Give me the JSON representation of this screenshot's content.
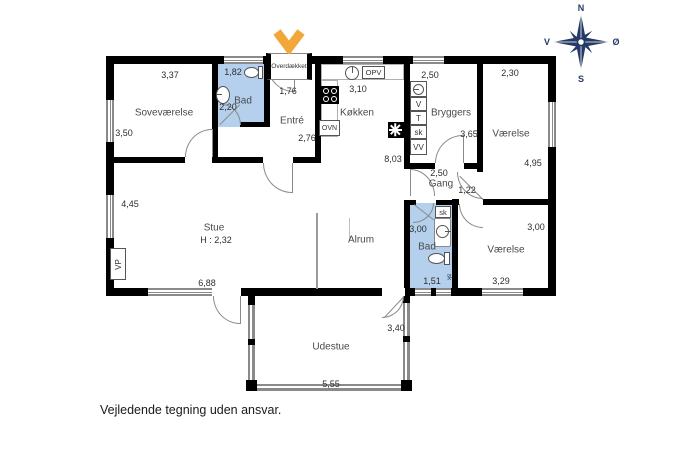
{
  "disclaimer": "Vejledende tegning uden ansvar.",
  "compass": {
    "north": "N",
    "south": "S",
    "west": "V",
    "east": "Ø"
  },
  "porch": {
    "label": "Overdækket",
    "dim": "1,76"
  },
  "rooms": {
    "sovevaerelse": {
      "name": "Soveværelse",
      "dim_top": "3,37",
      "dim_left": "3,50"
    },
    "bad_top": {
      "name": "Bad",
      "dim_top": "1,82",
      "dim_left": "2,20"
    },
    "entre": {
      "name": "Entré",
      "dim_right": "2,76"
    },
    "koekken": {
      "name": "Køkken",
      "dim_top": "3,10",
      "dim_bottom": "8,03",
      "labels": {
        "opv": "OPV",
        "ovn": "OVN"
      }
    },
    "bryggers": {
      "name": "Bryggers",
      "dim_top": "2,50",
      "dim_right": "3,65",
      "appliances": [
        "V",
        "T",
        "sk",
        "VV"
      ]
    },
    "vaerelse_ne": {
      "name": "Værelse",
      "dim_top": "2,30",
      "dim_right": "4,95"
    },
    "gang": {
      "name": "Gang",
      "dim_top": "2,50",
      "dim_diag": "1,22"
    },
    "stue": {
      "name": "Stue",
      "ceiling": "H : 2,32",
      "dim_left": "4,45",
      "dim_bottom": "6,88",
      "vp": "VP"
    },
    "alrum": {
      "name": "Alrum"
    },
    "bad_mid": {
      "name": "Bad",
      "dim_left": "3,00",
      "dim_bottom": "1,51",
      "sk": "sk",
      "sk_small": "sk"
    },
    "vaerelse_se": {
      "name": "Værelse",
      "dim_right": "3,00",
      "dim_bottom": "3,29"
    },
    "udestue": {
      "name": "Udestue",
      "dim_right": "3,40",
      "dim_bottom": "5,55"
    }
  },
  "colors": {
    "bath_fill": "#b5d0ed",
    "wall": "#000000",
    "marker_orange": "#f3a73b",
    "compass_navy": "#253a66"
  }
}
